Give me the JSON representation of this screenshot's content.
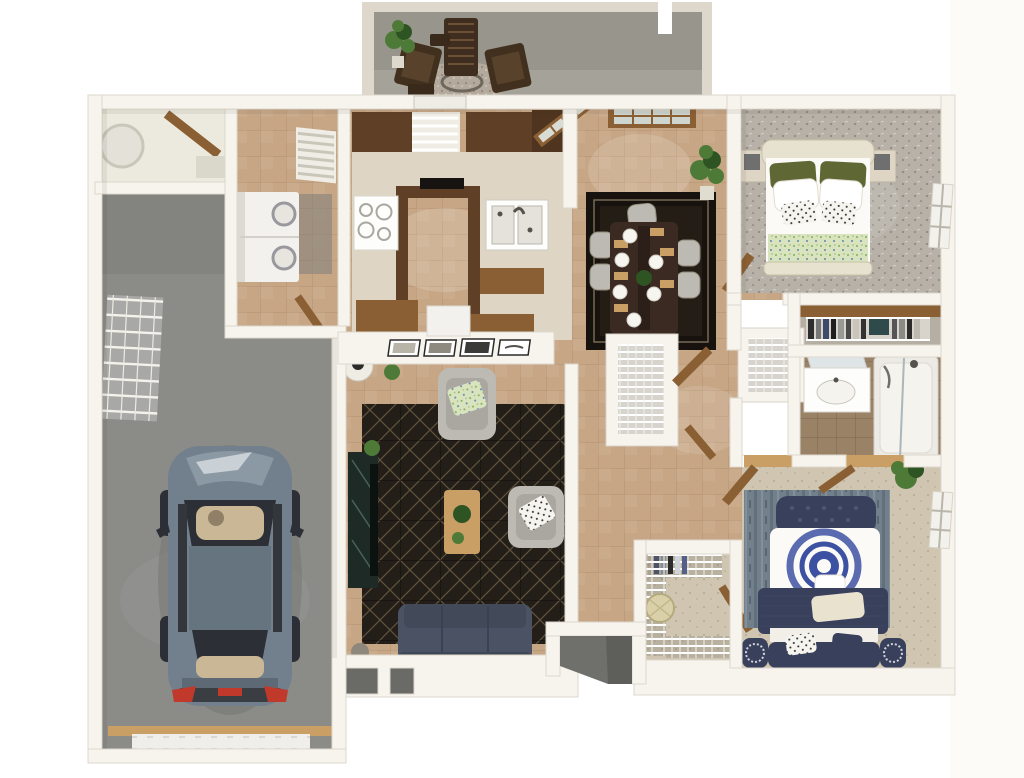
{
  "meta": {
    "title": "3D top-down apartment floor plan render",
    "type": "3d-floorplan"
  },
  "palette": {
    "bg": "#ffffff",
    "wall": "#f7f4ee",
    "wallEdge": "#d9d3c8",
    "tile": "#c7a685",
    "tileLine": "#8a6a4e",
    "garage": "#8b8b88",
    "garageDark": "#7d7d7a",
    "patio": "#98958c",
    "patioWall": "#ddd8cb",
    "carpet1": "#b7b1a8",
    "carpet2": "#cfc5b1",
    "bathTile": "#9a8267",
    "rug": "#241e18",
    "rugLine": "#93805e",
    "rugDining": "#17120e",
    "woodDark": "#5f4026",
    "woodMid": "#8a5f33",
    "woodLight": "#c99f66",
    "counter": "#ded5c4",
    "white": "#fdfdfb",
    "appliance": "#f2f1ed",
    "sofa": "#4b5263",
    "bedNavy": "#39405c",
    "medallion": "#3d51a3",
    "quilt": "#d9e4bf",
    "olive": "#5f6734",
    "grayChair": "#bdbab4",
    "car": "#72808d",
    "carDark": "#2c3036",
    "carRoof": "#667480",
    "carTan": "#c9b795",
    "red": "#c0392b",
    "plant": "#4e7a38",
    "plantDark": "#2f5423",
    "entry": "#6f6f6c",
    "glass": "#dfe5e6"
  },
  "rooms": [
    {
      "id": "patio",
      "label": "Patio",
      "furniture": [
        "two outdoor armchairs",
        "chaise lounge",
        "side table",
        "round gravel rug",
        "potted plant"
      ]
    },
    {
      "id": "garage",
      "label": "Garage",
      "furniture": [
        "car",
        "wire wall shelving",
        "garage door"
      ]
    },
    {
      "id": "utility-closet",
      "label": "Utility closet",
      "furniture": [
        "water heater"
      ]
    },
    {
      "id": "laundry-room",
      "label": "Laundry",
      "furniture": [
        "stacked washer-dryer",
        "louvered vent"
      ]
    },
    {
      "id": "kitchen",
      "label": "Kitchen",
      "furniture": [
        "u-shaped wood cabinets",
        "range",
        "double sink",
        "window with blinds",
        "bar stools"
      ]
    },
    {
      "id": "dining-area",
      "label": "Dining area",
      "furniture": [
        "dark wood table",
        "six upholstered chairs",
        "dark area rug",
        "french doors",
        "potted plant"
      ]
    },
    {
      "id": "living-room",
      "label": "Living room",
      "furniture": [
        "navy sofa",
        "two gray armchairs",
        "wood coffee table",
        "tv console",
        "gallery frames on half wall",
        "round side table",
        "plants",
        "geometric rug"
      ]
    },
    {
      "id": "bedroom-1",
      "label": "Bedroom 1",
      "furniture": [
        "bed with green accents",
        "two nightstands with lamps",
        "window",
        "reach-in closet"
      ]
    },
    {
      "id": "bathroom",
      "label": "Bathroom",
      "furniture": [
        "vanity sink with mirror",
        "tub shower with glass"
      ]
    },
    {
      "id": "hallway",
      "label": "Hallway",
      "furniture": [
        "two linen closets with wire shelves",
        "open wood doors"
      ]
    },
    {
      "id": "bedroom-2",
      "label": "Bedroom 2",
      "furniture": [
        "navy tufted bed with medallion duvet",
        "storage bench with speaker cushions",
        "blue area rug",
        "plant",
        "window"
      ]
    },
    {
      "id": "walk-in-closet",
      "label": "Walk-in closet",
      "furniture": [
        "wire shelving",
        "laundry basket",
        "hanging clothes"
      ]
    },
    {
      "id": "entry",
      "label": "Entry porch",
      "furniture": [
        "recessed front door"
      ]
    }
  ]
}
